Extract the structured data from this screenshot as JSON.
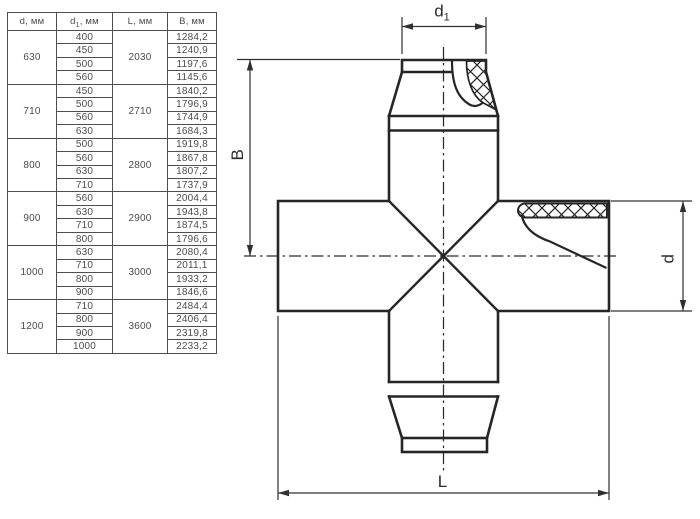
{
  "table": {
    "headers": [
      {
        "base": "d",
        "sub": "",
        "unit": ", мм"
      },
      {
        "base": "d",
        "sub": "1",
        "unit": ", мм"
      },
      {
        "base": "L",
        "sub": "",
        "unit": ", мм"
      },
      {
        "base": "B",
        "sub": "",
        "unit": ", мм"
      }
    ],
    "groups": [
      {
        "d": "630",
        "L": "2030",
        "rows": [
          {
            "d1": "400",
            "B": "1284,2"
          },
          {
            "d1": "450",
            "B": "1240,9"
          },
          {
            "d1": "500",
            "B": "1197,6"
          },
          {
            "d1": "560",
            "B": "1145,6"
          }
        ]
      },
      {
        "d": "710",
        "L": "2710",
        "rows": [
          {
            "d1": "450",
            "B": "1840,2"
          },
          {
            "d1": "500",
            "B": "1796,9"
          },
          {
            "d1": "560",
            "B": "1744,9"
          },
          {
            "d1": "630",
            "B": "1684,3"
          }
        ]
      },
      {
        "d": "800",
        "L": "2800",
        "rows": [
          {
            "d1": "500",
            "B": "1919,8"
          },
          {
            "d1": "560",
            "B": "1867,8"
          },
          {
            "d1": "630",
            "B": "1807,2"
          },
          {
            "d1": "710",
            "B": "1737,9"
          }
        ]
      },
      {
        "d": "900",
        "L": "2900",
        "rows": [
          {
            "d1": "560",
            "B": "2004,4"
          },
          {
            "d1": "630",
            "B": "1943,8"
          },
          {
            "d1": "710",
            "B": "1874,5"
          },
          {
            "d1": "800",
            "B": "1796,6"
          }
        ]
      },
      {
        "d": "1000",
        "L": "3000",
        "rows": [
          {
            "d1": "630",
            "B": "2080,4"
          },
          {
            "d1": "710",
            "B": "2011,1"
          },
          {
            "d1": "800",
            "B": "1933,2"
          },
          {
            "d1": "900",
            "B": "1846,6"
          }
        ]
      },
      {
        "d": "1200",
        "L": "3600",
        "rows": [
          {
            "d1": "710",
            "B": "2484,4"
          },
          {
            "d1": "800",
            "B": "2406,4"
          },
          {
            "d1": "900",
            "B": "2319,8"
          },
          {
            "d1": "1000",
            "B": "2233,2"
          }
        ]
      }
    ]
  },
  "drawing": {
    "dim_top": {
      "base": "d",
      "sub": "1"
    },
    "dim_left": "B",
    "dim_right": "d",
    "dim_bottom": "L"
  },
  "colors": {
    "line": "#262626",
    "table_border": "#4f4f4f",
    "text": "#4c4c4c",
    "background": "#ffffff"
  }
}
